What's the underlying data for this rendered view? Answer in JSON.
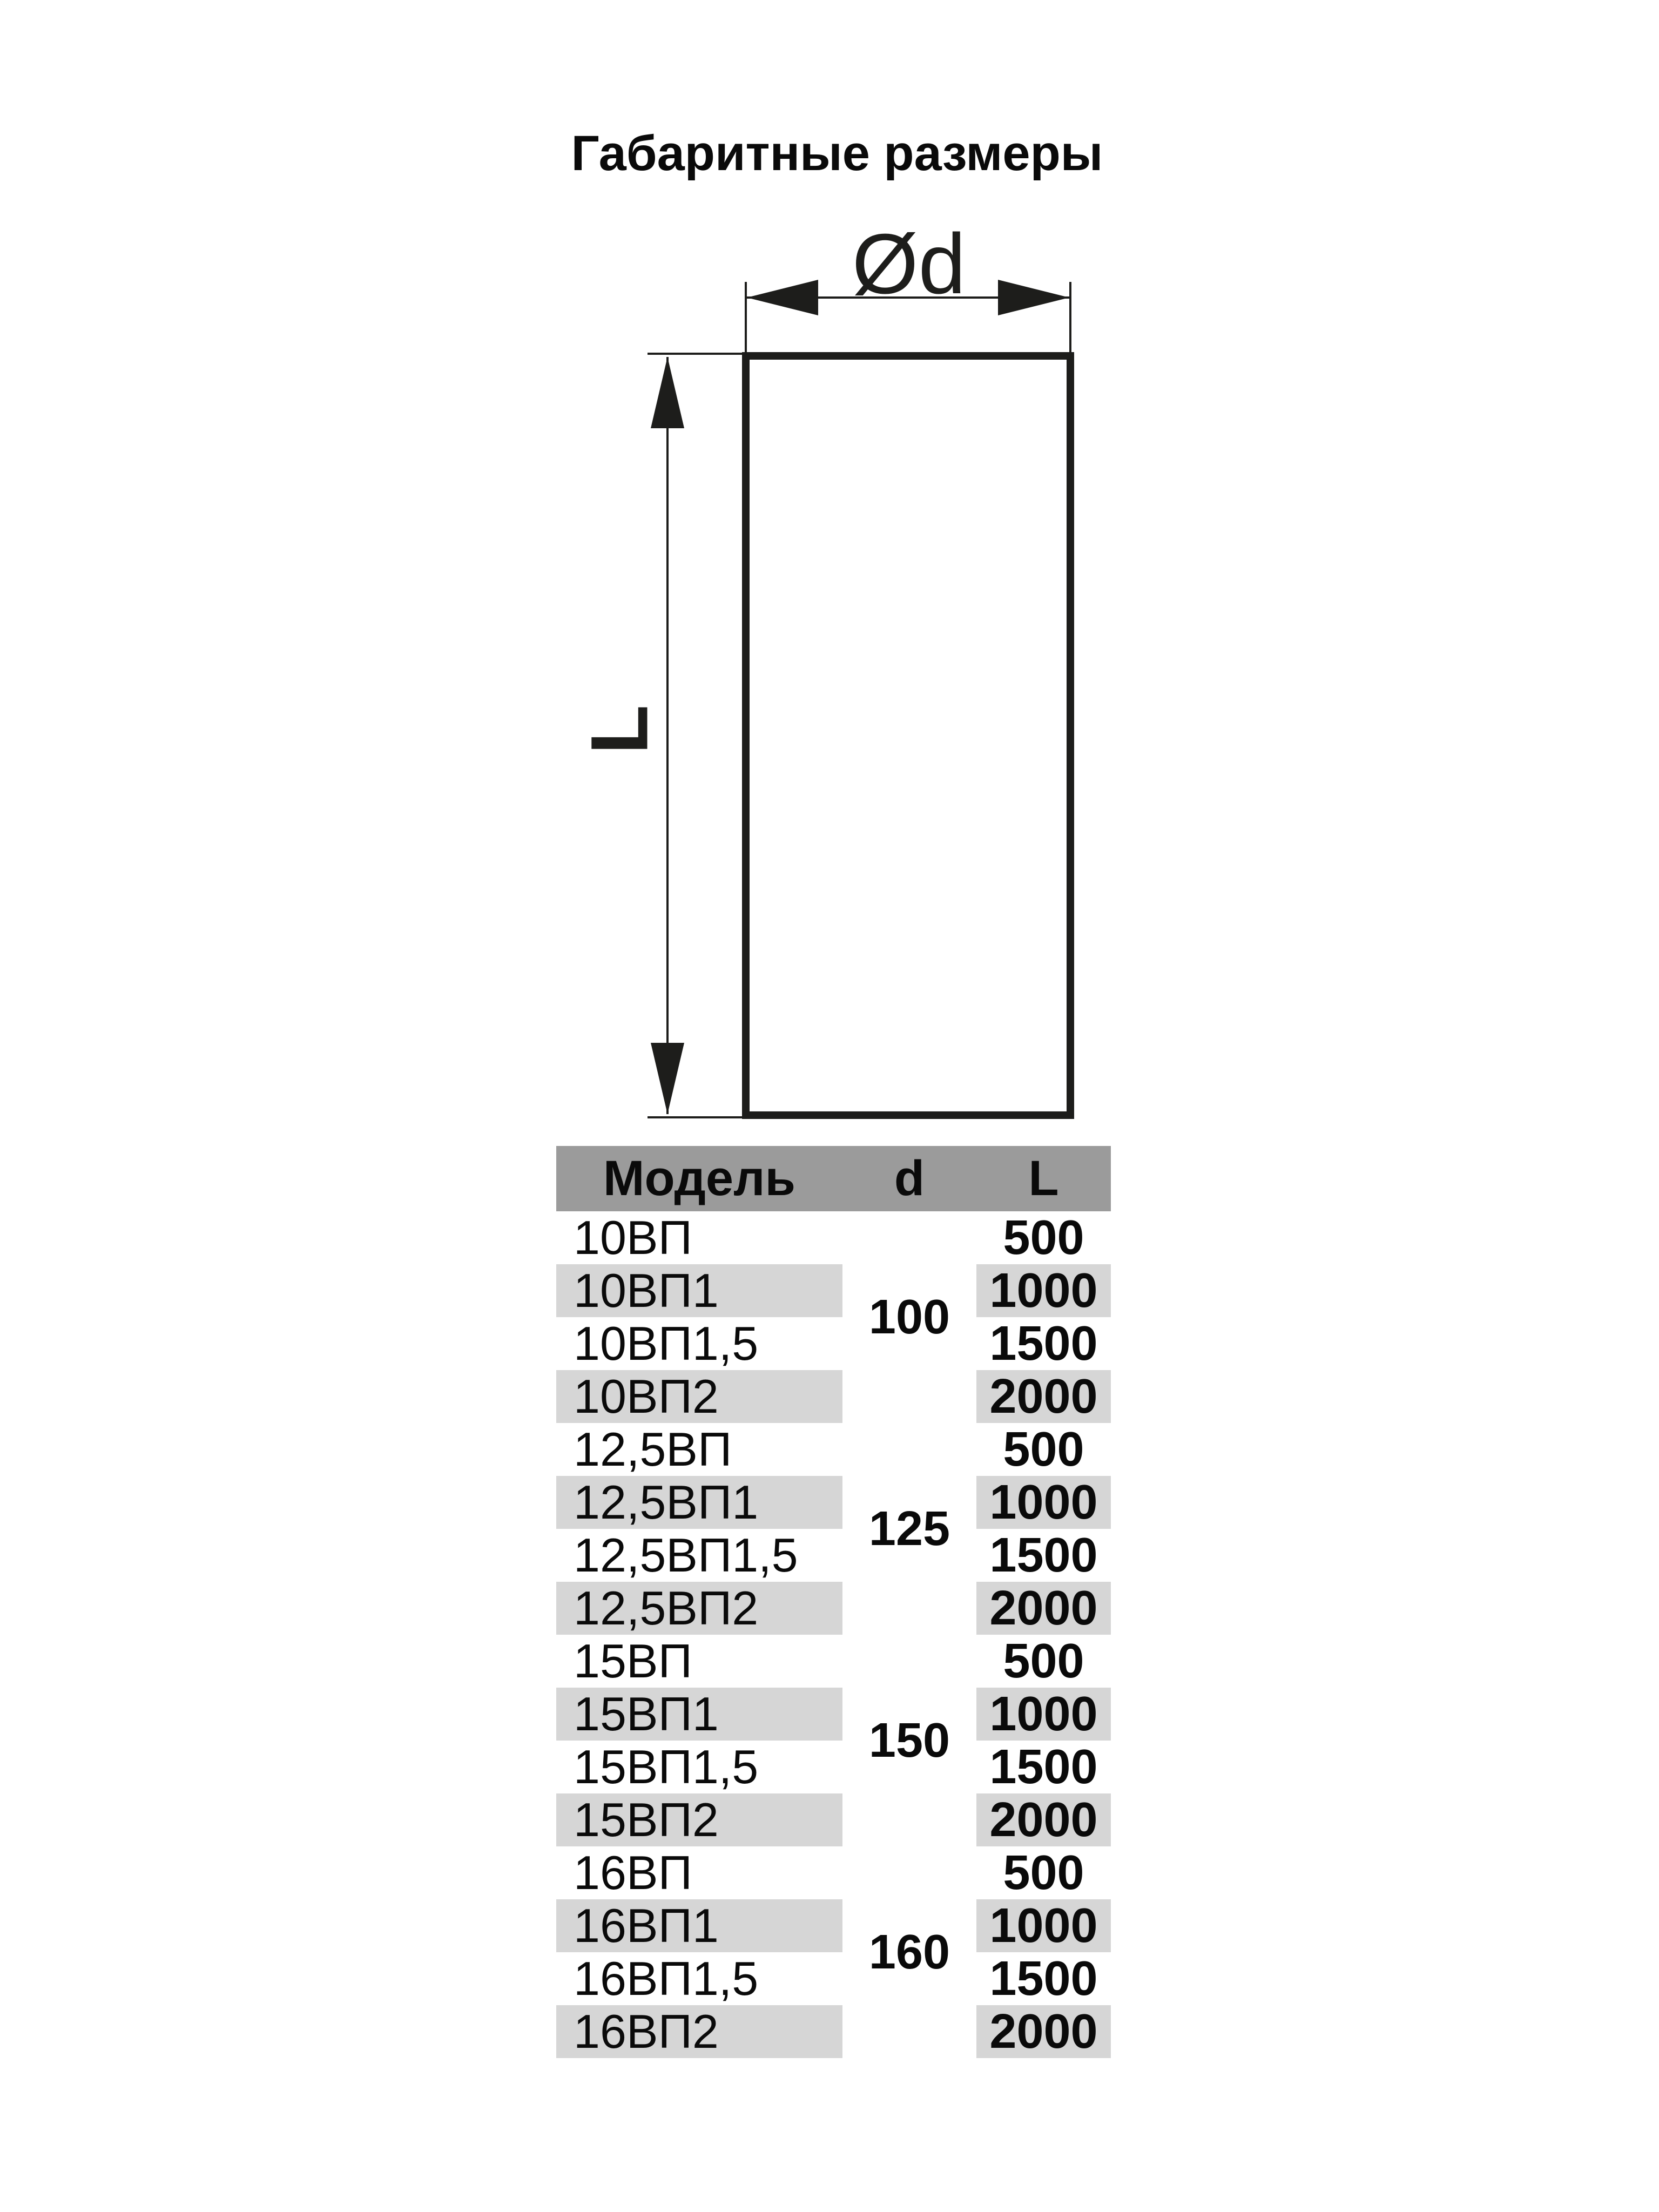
{
  "title": "Габаритные размеры",
  "diagram": {
    "width_label": "Ød",
    "height_label": "L",
    "stroke_color": "#1d1d1b"
  },
  "table": {
    "headers": {
      "model": "Модель",
      "d": "d",
      "l": "L"
    },
    "header_bg": "#9b9b9b",
    "row_band_bg": "#d6d6d6",
    "rows": [
      {
        "model": "10ВП",
        "d": "100",
        "l": "500"
      },
      {
        "model": "10ВП1",
        "d": "100",
        "l": "1000"
      },
      {
        "model": "10ВП1,5",
        "d": "100",
        "l": "1500"
      },
      {
        "model": "10ВП2",
        "d": "100",
        "l": "2000"
      },
      {
        "model": "12,5ВП",
        "d": "125",
        "l": "500"
      },
      {
        "model": "12,5ВП1",
        "d": "125",
        "l": "1000"
      },
      {
        "model": "12,5ВП1,5",
        "d": "125",
        "l": "1500"
      },
      {
        "model": "12,5ВП2",
        "d": "125",
        "l": "2000"
      },
      {
        "model": "15ВП",
        "d": "150",
        "l": "500"
      },
      {
        "model": "15ВП1",
        "d": "150",
        "l": "1000"
      },
      {
        "model": "15ВП1,5",
        "d": "150",
        "l": "1500"
      },
      {
        "model": "15ВП2",
        "d": "150",
        "l": "2000"
      },
      {
        "model": "16ВП",
        "d": "160",
        "l": "500"
      },
      {
        "model": "16ВП1",
        "d": "160",
        "l": "1000"
      },
      {
        "model": "16ВП1,5",
        "d": "160",
        "l": "1500"
      },
      {
        "model": "16ВП2",
        "d": "160",
        "l": "2000"
      }
    ],
    "d_groups": [
      {
        "d": "100"
      },
      {
        "d": "125"
      },
      {
        "d": "150"
      },
      {
        "d": "160"
      }
    ]
  }
}
